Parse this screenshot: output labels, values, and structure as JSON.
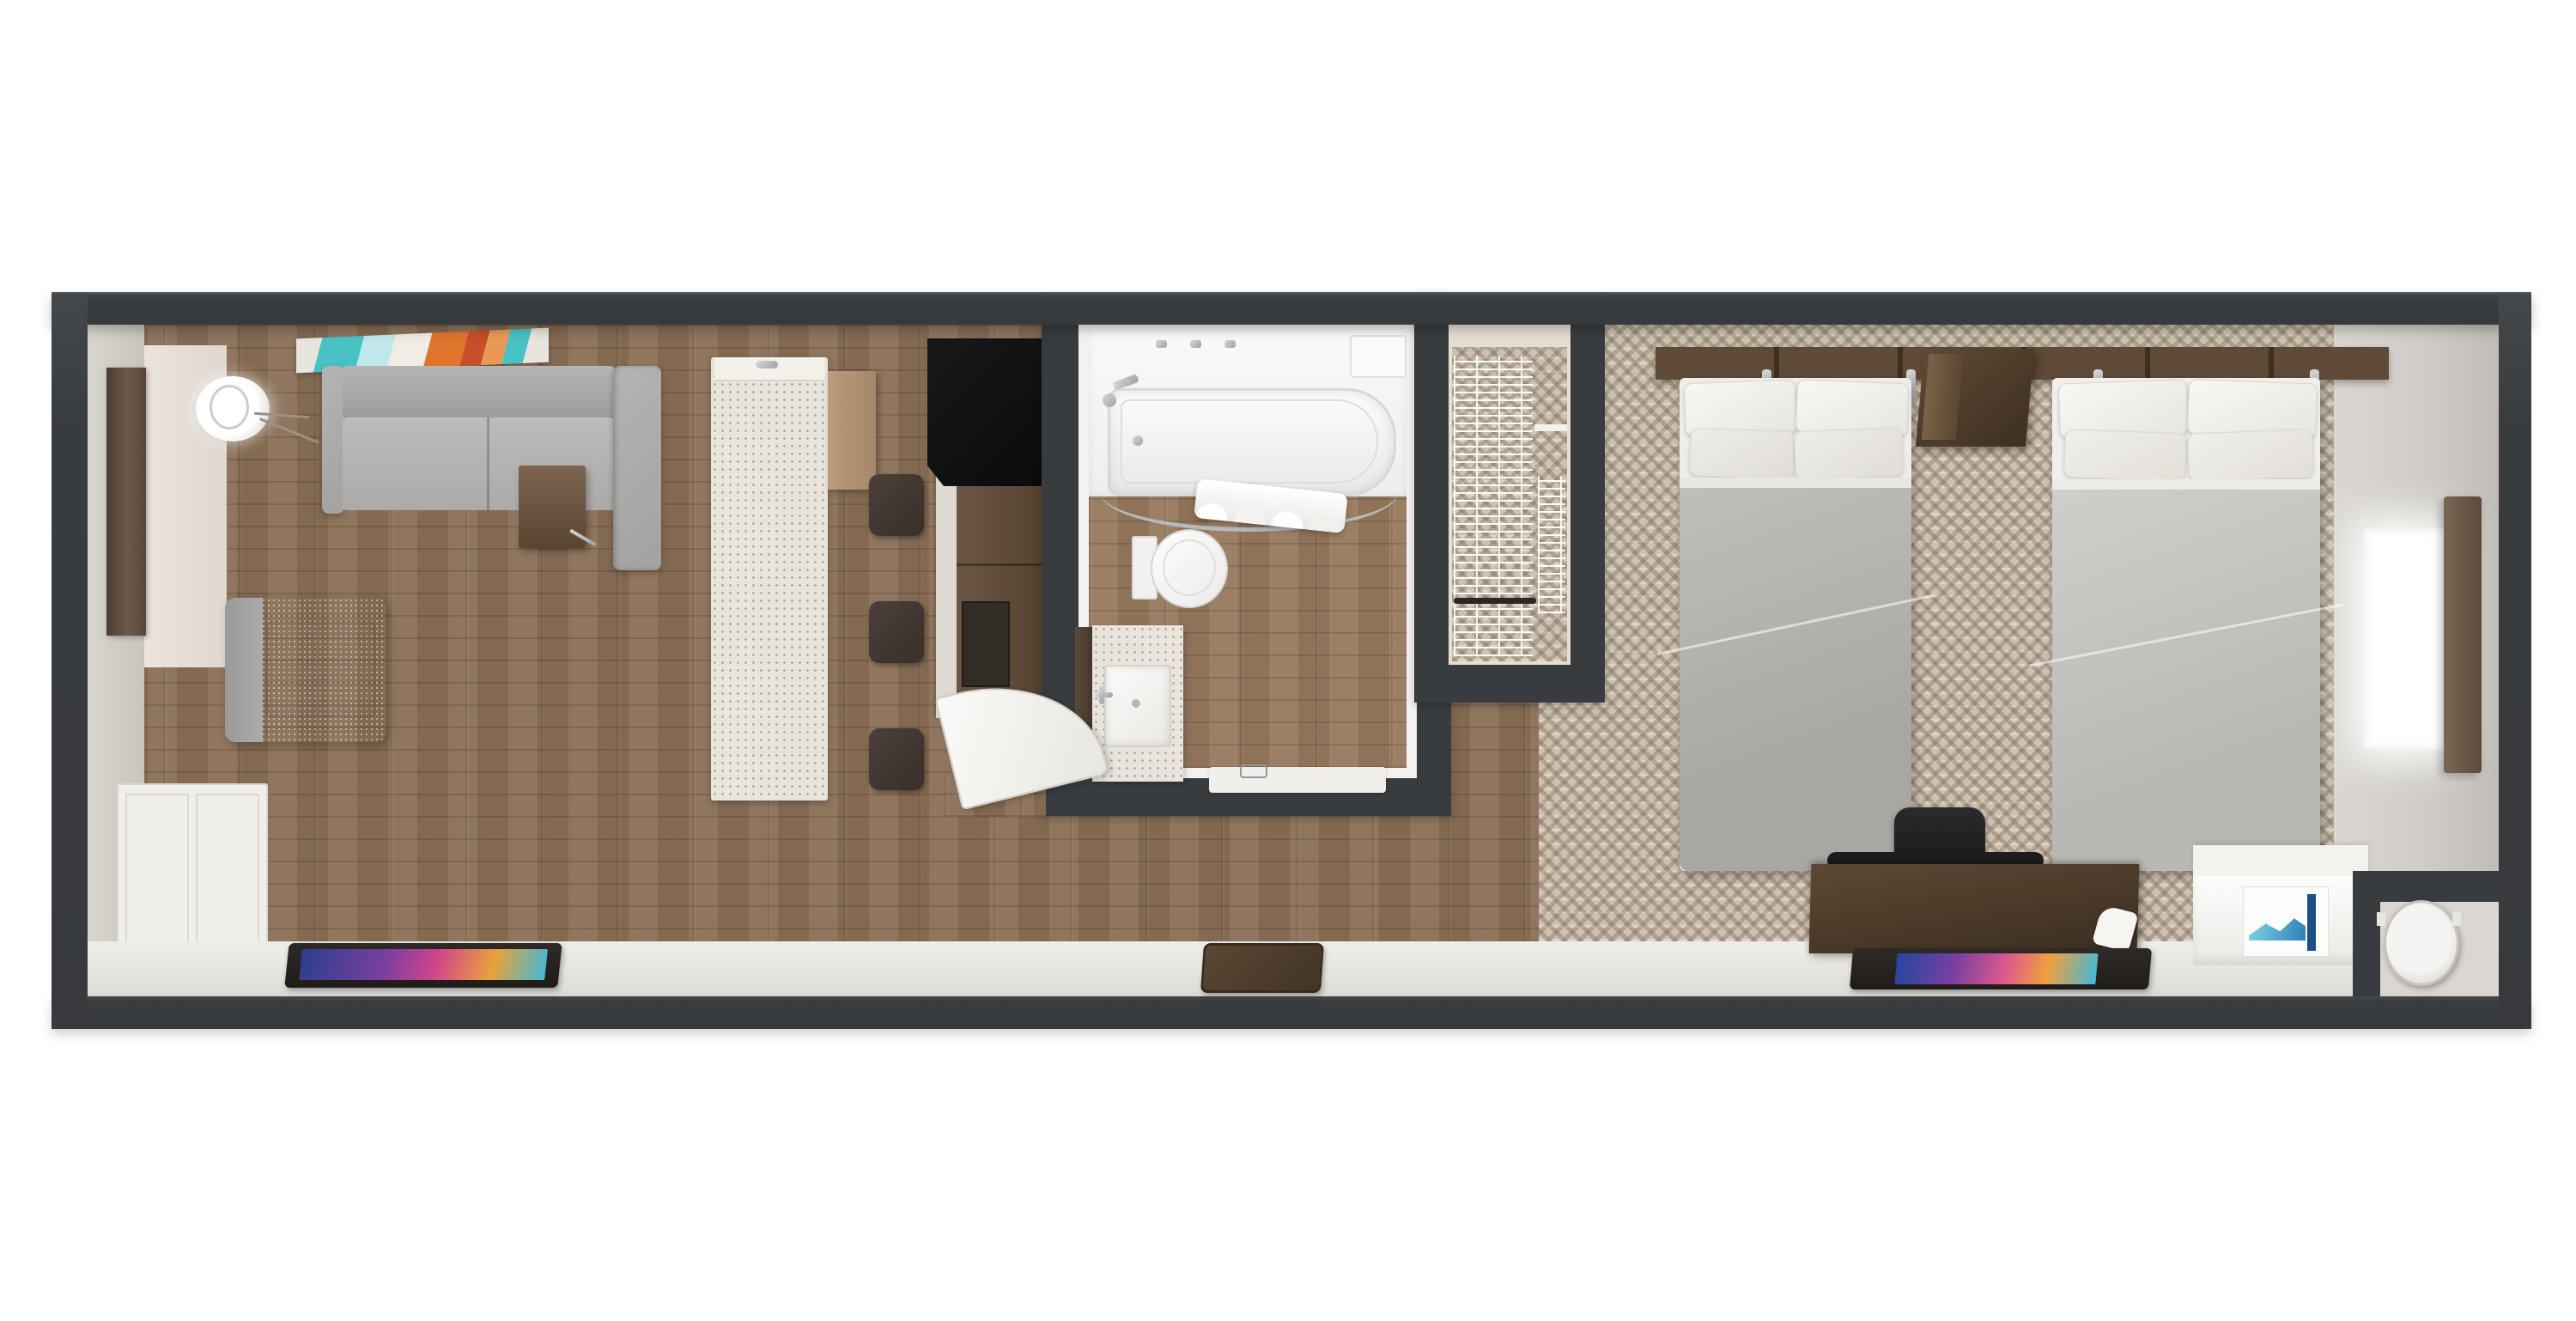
{
  "image_type": "3d-floorplan-top-view",
  "description": "Top-down 3D rendered floor plan of a hotel suite: living room with kitchenette on the left, central bathroom and closet, bedroom with two beds on the right",
  "palette": {
    "background": "#ffffff",
    "wall_dark": "#393c3f",
    "wall_top_face": "#b7c1ca",
    "wood_floor": "#8a6f55",
    "carpet": "#cdc2b1",
    "ledge_floor": "#e9e7e2",
    "island_terrazzo": "#e9e5dd",
    "counter_black": "#0c0d0f",
    "cabinet_wood": "#5f4c3b",
    "sofa_gray": "#a9a9a7",
    "duvet_gray": "#b3b2ae",
    "pillow_white": "#f6f5f2",
    "headboard_wood": "#55422f",
    "tv_screen_accent": "#7a3fa0",
    "art_teal": "#49c2c6",
    "art_orange": "#e0762e",
    "window_glow": "#ffffff",
    "curtain_brown": "#6e5b4a"
  },
  "rooms": [
    {
      "name": "living-room",
      "floor": "wood planks",
      "furniture": [
        "sectional-sofa",
        "side-table",
        "armchair",
        "floor-lamp",
        "wall-art",
        "mirror-panel",
        "wardrobe-doors",
        "wall-tv"
      ]
    },
    {
      "name": "kitchenette",
      "floor": "wood planks",
      "furniture": [
        "terrazzo-island",
        "island-faucet",
        "bar-stool x3",
        "black-countertop",
        "wood-base-cabinets",
        "counter-appliance",
        "tall-wood-cabinet"
      ]
    },
    {
      "name": "bathroom",
      "floor": "wood planks",
      "fixtures": [
        "bathtub",
        "tub-faucet",
        "shower-rod",
        "shower-curtain",
        "toilet",
        "vanity-terrazzo",
        "sink",
        "bath-mat",
        "swing-door"
      ]
    },
    {
      "name": "closet",
      "floor": "carpet",
      "fixtures": [
        "wire-shelving",
        "clothes-rod"
      ]
    },
    {
      "name": "bedroom",
      "floor": "patterned carpet",
      "furniture": [
        "bed-1",
        "bed-2",
        "headboard-panel",
        "wall-nightstand",
        "reading-sconce x4",
        "work-desk",
        "office-chair",
        "wall-tv",
        "luggage-bench",
        "blue-artwork",
        "ac-unit-alcove",
        "window",
        "curtain"
      ]
    }
  ],
  "counts": {
    "beds": 2,
    "bar_stools": 3,
    "tvs": 2,
    "doors_visible": 1,
    "windows_visible": 1
  }
}
